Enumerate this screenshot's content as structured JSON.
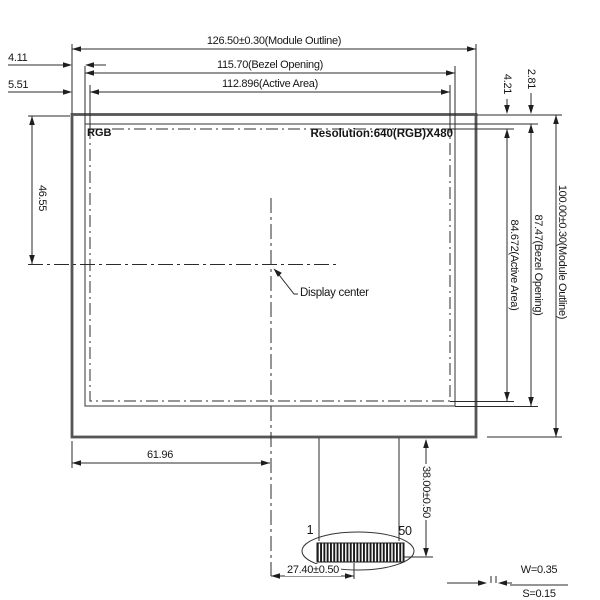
{
  "dims": {
    "module_w": "126.50±0.30(Module Outline)",
    "bezel_w": "115.70(Bezel Opening)",
    "active_w": "112.896(Active Area)",
    "bezel_left": "4.11",
    "active_left": "5.51",
    "active_top": "4.21",
    "bezel_top": "2.81",
    "active_h": "84.672(Active Area)",
    "bezel_h": "87.47(Bezel Opening)",
    "module_h": "100.00±0.30(Module Outline)",
    "center_from_top": "46.55",
    "center_from_left": "61.96",
    "fpc_length": "38.00±0.50",
    "fpc_width": "27.40±0.50",
    "pin_width": "W=0.35",
    "pin_space": "S=0.15"
  },
  "panel": {
    "mode": "RGB",
    "resolution": "Resolution:640(RGB)X480",
    "center_label": "Display center"
  },
  "connector": {
    "first_pin": "1",
    "last_pin": "50"
  },
  "colors": {
    "line": "#2b2b2b",
    "thick_line": "#555555",
    "text": "#161616",
    "background": "#ffffff"
  }
}
